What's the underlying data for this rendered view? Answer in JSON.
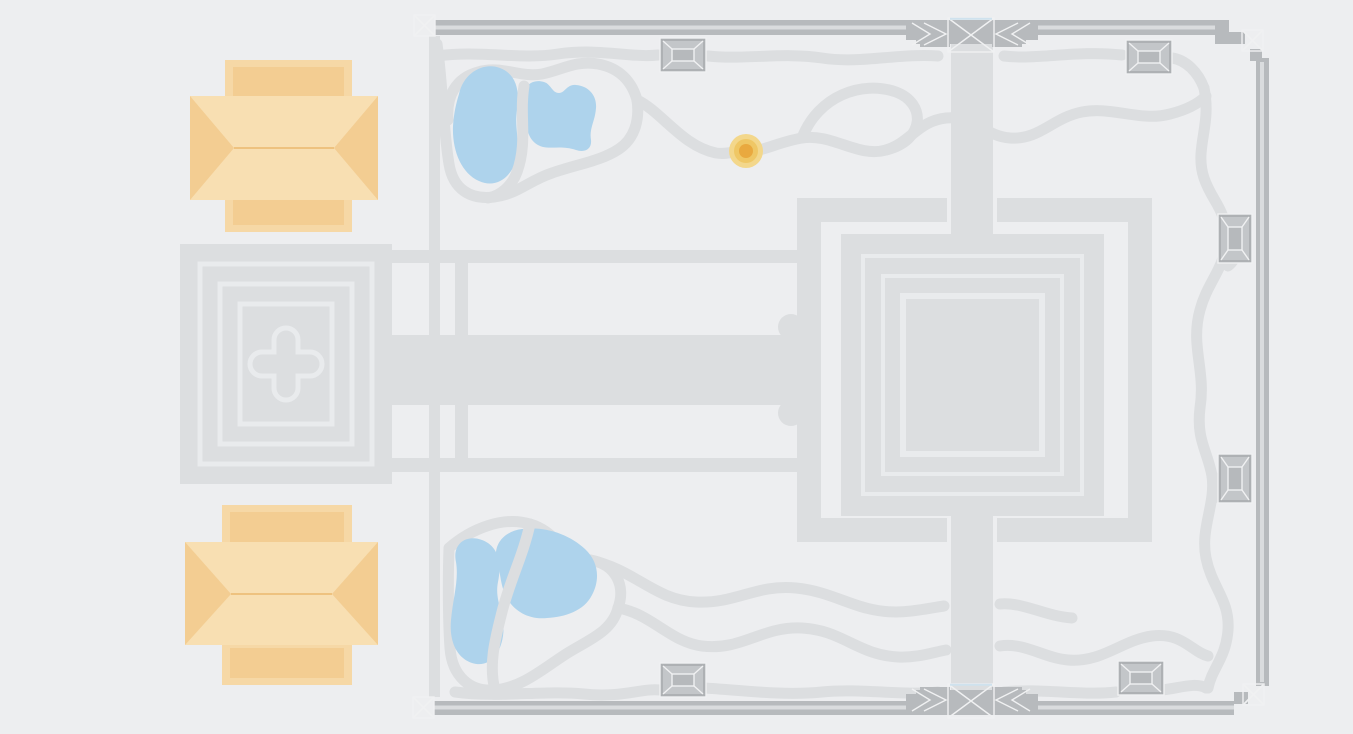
{
  "map": {
    "kind": "temple-complex-site-plan",
    "width": 1353,
    "height": 734
  },
  "colors": {
    "background": "#edeef0",
    "platform": "#dcdee0",
    "path": "#dcdee0",
    "outline": "#e9ebed",
    "wall": "#b7babd",
    "wall_light": "#dadcde",
    "tower_dark": "#aeb1b4",
    "tower_facet": "#c3c6c9",
    "tower_inner": "#b6b9bc",
    "bevel_line": "#f0f1f2",
    "pond": "#aed3ec",
    "building_light": "#f8dfb2",
    "building_mid": "#f3cd92",
    "building_shade": "#f6d8a6",
    "building_line": "#eec27f",
    "gate_highlight": "#cfe2ee",
    "marker_outer": "#f3d78b",
    "marker_mid": "#efc765",
    "marker_core": "#e9a93f"
  },
  "marker": {
    "cx": 746,
    "cy": 151,
    "r_outer": 17,
    "r_mid": 12,
    "r_core": 7
  },
  "features": {
    "pavilions": [
      "pavilion-north",
      "pavilion-south"
    ],
    "west_sanctuary": "stepped-square-with-quatrefoil",
    "central_sanctuary": "nested-square-temple",
    "terrace": "cruciform-causeway-terrace",
    "ponds": [
      "pond-nw-tall",
      "pond-nw-lobed",
      "pond-sw-tall",
      "pond-sw-round"
    ],
    "corner_gates": [
      "northwest",
      "northeast",
      "southwest",
      "southeast"
    ],
    "axis_gates": [
      "north-center",
      "south-center"
    ],
    "interior_shrines": [
      "nw-shrine",
      "ne-shrine",
      "sw-shrine",
      "se-shrine"
    ],
    "wall_towers": [
      "east-wall-north-tower",
      "east-wall-south-tower"
    ],
    "marker": "location-marker"
  }
}
